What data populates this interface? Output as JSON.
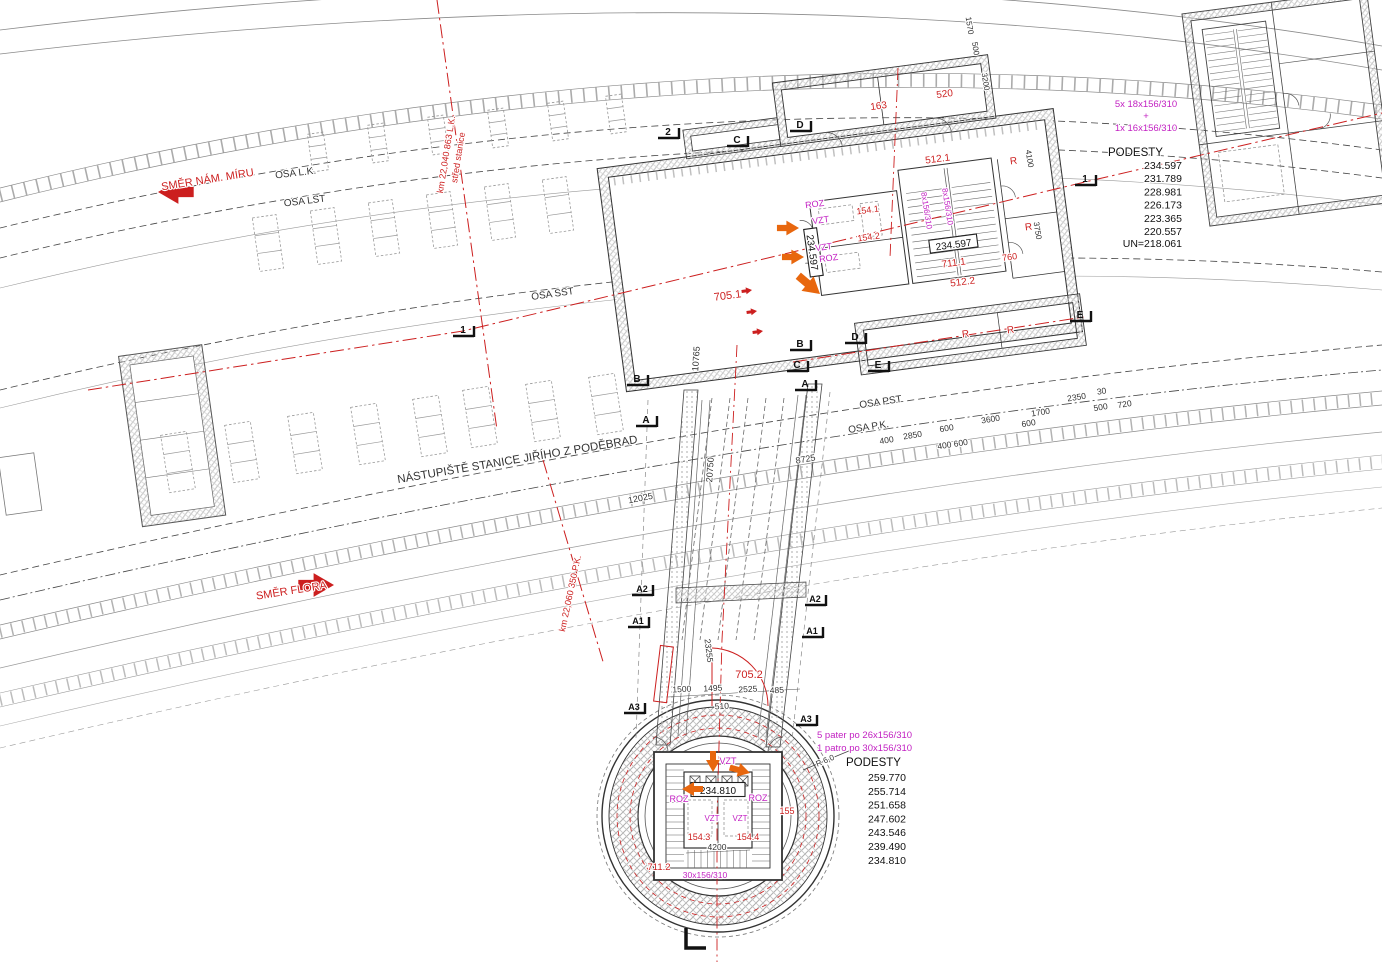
{
  "colors": {
    "red": "#cc1f1f",
    "magenta": "#c21fc2",
    "orange": "#e8670e",
    "line": "#333333",
    "dim": "#4a4a4a",
    "gray": "#9a9a9a"
  },
  "podesty_top": {
    "stair_formula_1": "5x 18x156/310",
    "plus": "+",
    "stair_formula_2": "1x 16x156/310",
    "title": "PODESTY",
    "levels": [
      "234.597",
      "231.789",
      "228.981",
      "226.173",
      "223.365",
      "220.557"
    ],
    "base": "UN=218.061"
  },
  "podesty_bottom": {
    "stair_formula_1": "5 pater  po 26x156/310",
    "stair_formula_2": "1 patro  po 30x156/310",
    "title": "PODESTY",
    "levels": [
      "259.770",
      "255.714",
      "251.658",
      "247.602",
      "243.546",
      "239.490",
      "234.810"
    ]
  },
  "boxes": [
    {
      "id": "level-box-234597-a",
      "text": "234.597",
      "x": 954,
      "y": 248,
      "rot": -7.5,
      "w": 48,
      "h": 13
    },
    {
      "id": "level-box-234597-b",
      "text": "234.597",
      "x": 809,
      "y": 253,
      "rot": 82,
      "w": 48,
      "h": 13
    },
    {
      "id": "level-box-234810",
      "text": "234.810",
      "x": 718,
      "y": 794,
      "rot": 0,
      "w": 54,
      "h": 14
    }
  ],
  "markers": [
    {
      "t": "2",
      "x": 668,
      "y": 135
    },
    {
      "t": "C",
      "x": 737,
      "y": 143
    },
    {
      "t": "D",
      "x": 800,
      "y": 128
    },
    {
      "t": "1",
      "x": 463,
      "y": 333
    },
    {
      "t": "B",
      "x": 637,
      "y": 382
    },
    {
      "t": "A",
      "x": 646,
      "y": 423
    },
    {
      "t": "B",
      "x": 800,
      "y": 347
    },
    {
      "t": "D",
      "x": 855,
      "y": 340
    },
    {
      "t": "C",
      "x": 797,
      "y": 368
    },
    {
      "t": "E",
      "x": 878,
      "y": 368
    },
    {
      "t": "A",
      "x": 805,
      "y": 387
    },
    {
      "t": "1",
      "x": 1085,
      "y": 182
    },
    {
      "t": "E",
      "x": 1080,
      "y": 318
    },
    {
      "t": "A2",
      "x": 642,
      "y": 592
    },
    {
      "t": "A2",
      "x": 815,
      "y": 602
    },
    {
      "t": "A1",
      "x": 638,
      "y": 624
    },
    {
      "t": "A1",
      "x": 812,
      "y": 634
    },
    {
      "t": "A3",
      "x": 634,
      "y": 710
    },
    {
      "t": "A3",
      "x": 806,
      "y": 722
    }
  ],
  "arrows": [
    {
      "id": "smer-nam-miru-arrow",
      "x": 158,
      "y": 192,
      "a": 180,
      "s": 1.7,
      "c": "red"
    },
    {
      "id": "smer-flora-arrow",
      "x": 334,
      "y": 585,
      "a": 0,
      "s": 1.7,
      "c": "red"
    },
    {
      "id": "flow-arrow-1",
      "x": 799,
      "y": 228,
      "a": 0,
      "s": 1.05,
      "c": "orange"
    },
    {
      "id": "flow-arrow-2",
      "x": 804,
      "y": 257,
      "a": 0,
      "s": 1.05,
      "c": "orange"
    },
    {
      "id": "flow-arrow-3",
      "x": 820,
      "y": 294,
      "a": 40,
      "s": 1.35,
      "c": "orange"
    },
    {
      "id": "flow-arrow-4",
      "x": 713,
      "y": 772,
      "a": 90,
      "s": 1.0,
      "c": "orange"
    },
    {
      "id": "flow-arrow-5",
      "x": 750,
      "y": 773,
      "a": 15,
      "s": 1.0,
      "c": "orange"
    },
    {
      "id": "flow-arrow-6",
      "x": 682,
      "y": 789,
      "a": 180,
      "s": 1.0,
      "c": "orange"
    },
    {
      "id": "red-tick-1",
      "x": 752,
      "y": 290,
      "a": -8,
      "s": 0.5,
      "c": "red"
    },
    {
      "id": "red-tick-2",
      "x": 757,
      "y": 311,
      "a": -8,
      "s": 0.5,
      "c": "red"
    },
    {
      "id": "red-tick-3",
      "x": 763,
      "y": 331,
      "a": -8,
      "s": 0.5,
      "c": "red"
    }
  ],
  "benches": [
    {
      "x": 318,
      "y": 152,
      "w": 16,
      "h": 38,
      "rot": -8
    },
    {
      "x": 378,
      "y": 143,
      "w": 16,
      "h": 38,
      "rot": -8
    },
    {
      "x": 438,
      "y": 135,
      "w": 16,
      "h": 38,
      "rot": -8
    },
    {
      "x": 498,
      "y": 128,
      "w": 16,
      "h": 38,
      "rot": -8
    },
    {
      "x": 558,
      "y": 121,
      "w": 16,
      "h": 38,
      "rot": -8
    },
    {
      "x": 616,
      "y": 114,
      "w": 16,
      "h": 38,
      "rot": -8
    },
    {
      "x": 268,
      "y": 243,
      "w": 24,
      "h": 54,
      "rot": -8
    },
    {
      "x": 326,
      "y": 236,
      "w": 24,
      "h": 54,
      "rot": -8
    },
    {
      "x": 384,
      "y": 228,
      "w": 24,
      "h": 54,
      "rot": -8
    },
    {
      "x": 442,
      "y": 220,
      "w": 24,
      "h": 54,
      "rot": -8
    },
    {
      "x": 500,
      "y": 212,
      "w": 24,
      "h": 54,
      "rot": -8
    },
    {
      "x": 558,
      "y": 205,
      "w": 24,
      "h": 54,
      "rot": -8
    },
    {
      "x": 178,
      "y": 462,
      "w": 26,
      "h": 58,
      "rot": -9
    },
    {
      "x": 242,
      "y": 452,
      "w": 26,
      "h": 58,
      "rot": -9
    },
    {
      "x": 305,
      "y": 443,
      "w": 26,
      "h": 58,
      "rot": -9
    },
    {
      "x": 368,
      "y": 434,
      "w": 26,
      "h": 58,
      "rot": -9
    },
    {
      "x": 430,
      "y": 426,
      "w": 26,
      "h": 58,
      "rot": -9
    },
    {
      "x": 480,
      "y": 417,
      "w": 26,
      "h": 58,
      "rot": -9
    },
    {
      "x": 543,
      "y": 411,
      "w": 26,
      "h": 58,
      "rot": -9
    },
    {
      "x": 606,
      "y": 404,
      "w": 26,
      "h": 58,
      "rot": -9
    }
  ],
  "annotations": [
    {
      "id": "smer-nam-miru",
      "text": "SMĚR NÁM. MÍRU",
      "x": 208,
      "y": 183,
      "rot": -9,
      "color": "red",
      "size": 11
    },
    {
      "id": "osa-lk",
      "text": "OSA L.K.",
      "x": 296,
      "y": 176,
      "rot": -7,
      "size": 10
    },
    {
      "id": "osa-lst",
      "text": "OSA LST",
      "x": 305,
      "y": 204,
      "rot": -7,
      "size": 10
    },
    {
      "id": "km-lk-line1",
      "text": "km 22,040 863 L.K.",
      "x": 449,
      "y": 155,
      "rot": -81,
      "color": "red",
      "size": 9
    },
    {
      "id": "km-lk-line2",
      "text": "střed stanice",
      "x": 461,
      "y": 158,
      "rot": -81,
      "color": "red",
      "size": 9
    },
    {
      "id": "osa-sst",
      "text": "OSA SST",
      "x": 553,
      "y": 297,
      "rot": -8,
      "size": 10
    },
    {
      "id": "nastupiste",
      "text": "NÁSTUPIŠTĚ STANICE JIŘÍHO Z PODĚBRAD",
      "x": 518,
      "y": 463,
      "rot": -9.5,
      "size": 11.5
    },
    {
      "id": "smer-flora",
      "text": "SMĚR FLORA",
      "x": 292,
      "y": 594,
      "rot": -9,
      "color": "red",
      "size": 11
    },
    {
      "id": "km-pk",
      "text": "km 22,060 350 P.K.",
      "x": 573,
      "y": 594,
      "rot": -78,
      "color": "red",
      "size": 9
    },
    {
      "id": "osa-pst",
      "text": "OSA PST",
      "x": 881,
      "y": 405,
      "rot": -8.5,
      "size": 10
    },
    {
      "id": "osa-pk",
      "text": "OSA P.K.",
      "x": 869,
      "y": 430,
      "rot": -8.5,
      "size": 10
    },
    {
      "id": "dim-400",
      "text": "400",
      "x": 887,
      "y": 443,
      "rot": -9,
      "size": 8.5
    },
    {
      "id": "dim-2850",
      "text": "2850",
      "x": 913,
      "y": 438,
      "rot": -9,
      "size": 8.5
    },
    {
      "id": "dim-600a",
      "text": "600",
      "x": 947,
      "y": 431,
      "rot": -9,
      "size": 8.5
    },
    {
      "id": "dim-400600",
      "text": "400 600",
      "x": 953,
      "y": 447,
      "rot": -9,
      "size": 8.5
    },
    {
      "id": "dim-3600",
      "text": "3600",
      "x": 991,
      "y": 422,
      "rot": -9,
      "size": 8.5
    },
    {
      "id": "dim-600b",
      "text": "600",
      "x": 1029,
      "y": 426,
      "rot": -9,
      "size": 8.5
    },
    {
      "id": "dim-1700",
      "text": "1700",
      "x": 1041,
      "y": 415,
      "rot": -9,
      "size": 8.5
    },
    {
      "id": "dim-2350",
      "text": "2350",
      "x": 1077,
      "y": 400,
      "rot": -9,
      "size": 8.5
    },
    {
      "id": "dim-30",
      "text": "30",
      "x": 1102,
      "y": 394,
      "rot": -9,
      "size": 8.5
    },
    {
      "id": "dim-500",
      "text": "500",
      "x": 1101,
      "y": 410,
      "rot": -9,
      "size": 8.5
    },
    {
      "id": "dim-720",
      "text": "720",
      "x": 1125,
      "y": 407,
      "rot": -9,
      "size": 8.5
    },
    {
      "id": "dim-8725",
      "text": "8725",
      "x": 806,
      "y": 462,
      "rot": -10,
      "size": 9
    },
    {
      "id": "dim-20750",
      "text": "20750",
      "x": 713,
      "y": 470,
      "rot": -86,
      "size": 9
    },
    {
      "id": "dim-12025",
      "text": "12025",
      "x": 641,
      "y": 501,
      "rot": -11,
      "size": 9
    },
    {
      "id": "dim-10765",
      "text": "10765",
      "x": 699,
      "y": 359,
      "rot": -86,
      "size": 9
    },
    {
      "id": "room-163",
      "text": "163",
      "x": 879,
      "y": 109,
      "rot": -7.5,
      "color": "red",
      "size": 10
    },
    {
      "id": "room-520",
      "text": "520",
      "x": 945,
      "y": 97,
      "rot": -7.5,
      "color": "red",
      "size": 10
    },
    {
      "id": "room-512-1",
      "text": "512.1",
      "x": 938,
      "y": 162,
      "rot": -7.5,
      "color": "red",
      "size": 10
    },
    {
      "id": "room-154-1",
      "text": "154.1",
      "x": 868,
      "y": 213,
      "rot": -7.5,
      "color": "red",
      "size": 9
    },
    {
      "id": "room-154-2",
      "text": "154.2",
      "x": 869,
      "y": 240,
      "rot": -7.5,
      "color": "red",
      "size": 9
    },
    {
      "id": "room-711-1",
      "text": "711.1",
      "x": 954,
      "y": 266,
      "rot": -7.5,
      "color": "red",
      "size": 10
    },
    {
      "id": "room-512-2",
      "text": "512.2",
      "x": 963,
      "y": 285,
      "rot": -7.5,
      "color": "red",
      "size": 10
    },
    {
      "id": "room-760",
      "text": "760",
      "x": 1010,
      "y": 260,
      "rot": -7.5,
      "color": "red",
      "size": 9
    },
    {
      "id": "room-705-1",
      "text": "705.1",
      "x": 728,
      "y": 299,
      "rot": -7.5,
      "color": "red",
      "size": 11
    },
    {
      "id": "room-r-1",
      "text": "R",
      "x": 1014,
      "y": 164,
      "rot": -7.5,
      "color": "red",
      "size": 10
    },
    {
      "id": "room-r-2",
      "text": "R",
      "x": 1029,
      "y": 230,
      "rot": -7.5,
      "color": "red",
      "size": 10
    },
    {
      "id": "room-r-3",
      "text": "R",
      "x": 966,
      "y": 337,
      "rot": -7.5,
      "color": "red",
      "size": 10
    },
    {
      "id": "room-r-4",
      "text": "R",
      "x": 1011,
      "y": 333,
      "rot": -7.5,
      "color": "red",
      "size": 10
    },
    {
      "id": "dim-4100",
      "text": "4100",
      "x": 1027,
      "y": 159,
      "rot": 81,
      "size": 8
    },
    {
      "id": "dim-3750",
      "text": "3750",
      "x": 1035,
      "y": 231,
      "rot": 81,
      "size": 8
    },
    {
      "id": "dim-1570",
      "text": "1570",
      "x": 967,
      "y": 26,
      "rot": 81,
      "size": 8
    },
    {
      "id": "dim-500t",
      "text": "500",
      "x": 973,
      "y": 49,
      "rot": 81,
      "size": 8
    },
    {
      "id": "dim-3200",
      "text": "3200",
      "x": 983,
      "y": 82,
      "rot": 81,
      "size": 8
    },
    {
      "id": "label-roz-1",
      "text": "ROZ",
      "x": 815,
      "y": 207,
      "rot": -7.5,
      "color": "magenta",
      "size": 9
    },
    {
      "id": "label-vzt-1",
      "text": "VZT",
      "x": 821,
      "y": 223,
      "rot": -7.5,
      "color": "magenta",
      "size": 9
    },
    {
      "id": "label-vzt-2",
      "text": "VZT",
      "x": 824,
      "y": 250,
      "rot": -7.5,
      "color": "magenta",
      "size": 9
    },
    {
      "id": "label-roz-2",
      "text": "ROZ",
      "x": 829,
      "y": 261,
      "rot": -7.5,
      "color": "magenta",
      "size": 9
    },
    {
      "id": "stair-8x-a",
      "text": "8x156/310",
      "x": 924,
      "y": 211,
      "rot": 81,
      "color": "magenta",
      "size": 8
    },
    {
      "id": "stair-8x-b",
      "text": "8x156/310",
      "x": 945,
      "y": 207,
      "rot": 81,
      "color": "magenta",
      "size": 8
    },
    {
      "id": "room-705-2",
      "text": "705.2",
      "x": 749,
      "y": 678,
      "rot": 0,
      "color": "red",
      "size": 11
    },
    {
      "id": "dim-23255",
      "text": "23255",
      "x": 706,
      "y": 651,
      "rot": 83,
      "size": 8.5
    },
    {
      "id": "dim-1500",
      "text": "1500",
      "x": 682,
      "y": 692,
      "rot": -3,
      "size": 8.5
    },
    {
      "id": "dim-1495",
      "text": "1495",
      "x": 713,
      "y": 691,
      "rot": -3,
      "size": 8.5
    },
    {
      "id": "dim-2525",
      "text": "2525",
      "x": 748,
      "y": 692,
      "rot": -3,
      "size": 8.5
    },
    {
      "id": "dim-485",
      "text": "485",
      "x": 777,
      "y": 693,
      "rot": -3,
      "size": 8.5
    },
    {
      "id": "dim-510",
      "text": "510",
      "x": 722,
      "y": 709,
      "rot": -3,
      "size": 8.5
    },
    {
      "id": "shaft-vzt-top",
      "text": "VZT",
      "x": 728,
      "y": 764,
      "rot": 0,
      "color": "magenta",
      "size": 9
    },
    {
      "id": "shaft-roz-left",
      "text": "ROZ",
      "x": 679,
      "y": 802,
      "rot": 0,
      "color": "magenta",
      "size": 9
    },
    {
      "id": "shaft-roz-right",
      "text": "ROZ",
      "x": 758,
      "y": 801,
      "rot": 0,
      "color": "magenta",
      "size": 9
    },
    {
      "id": "room-155",
      "text": "155",
      "x": 787,
      "y": 814,
      "rot": 0,
      "color": "red",
      "size": 9
    },
    {
      "id": "shaft-vzt-a",
      "text": "VZT",
      "x": 712,
      "y": 821,
      "rot": 0,
      "color": "magenta",
      "size": 8
    },
    {
      "id": "shaft-vzt-b",
      "text": "VZT",
      "x": 740,
      "y": 821,
      "rot": 0,
      "color": "magenta",
      "size": 8
    },
    {
      "id": "room-154-3",
      "text": "154.3",
      "x": 699,
      "y": 840,
      "rot": 0,
      "color": "red",
      "size": 9
    },
    {
      "id": "room-154-4",
      "text": "154.4",
      "x": 748,
      "y": 840,
      "rot": 0,
      "color": "red",
      "size": 9
    },
    {
      "id": "dim-4200",
      "text": "4200",
      "x": 717,
      "y": 850,
      "rot": 0,
      "size": 8.5
    },
    {
      "id": "room-711-2",
      "text": "711.2",
      "x": 659,
      "y": 870,
      "rot": 0,
      "color": "red",
      "size": 9.5
    },
    {
      "id": "stair-30x",
      "text": "30x156/310",
      "x": 705,
      "y": 878,
      "rot": 0,
      "color": "magenta",
      "size": 8.5
    },
    {
      "id": "shaft-radius",
      "text": "R 6,0",
      "x": 826,
      "y": 763,
      "rot": -23,
      "size": 8
    }
  ]
}
